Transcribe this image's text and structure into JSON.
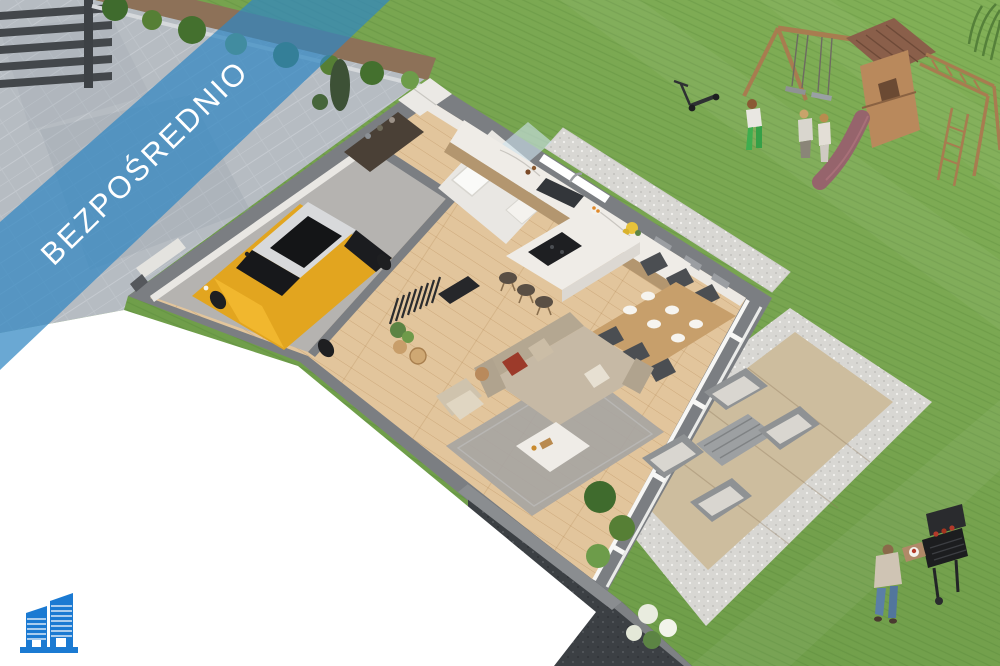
{
  "banner": {
    "label": "BEZPOŚREDNIO"
  },
  "logo": {
    "icon": "buildings-icon"
  },
  "palette": {
    "banner_blue": "#3187c2",
    "logo_blue": "#1b7ad2",
    "text_white": "#ffffff",
    "lawn_green": "#74a14d",
    "lawn_green_light": "#82b157",
    "driveway_gray": "#b6bcc2",
    "wall_gray": "#7b7e82",
    "floor_wood": "#e2c59c",
    "garage_floor": "#b5b3b0",
    "marble_white": "#efece7",
    "cabinet_wood": "#b3966f",
    "dining_wood": "#c79f6b",
    "sofa_beige": "#c6b9a5",
    "rug_gray": "#a6a4a2",
    "chair_dark": "#4b4e52",
    "car_yellow": "#e2a51f",
    "gravel_light": "#d8d7d3",
    "patio_beige": "#cdbd9e",
    "foundation_dark": "#3c4044",
    "playground_wood": "#b9895c",
    "slide_mauve": "#96646c",
    "hedge_mulch": "#8d7158",
    "bush_green": "#4e7a34",
    "fence_dark": "#43474b"
  },
  "scene": {
    "elements": [
      "driveway",
      "fence",
      "hedge",
      "lawn",
      "garage",
      "yellow-car",
      "hallway",
      "bathroom",
      "wardrobe",
      "kitchen",
      "kitchen-island",
      "dining-set",
      "living-room-sofa",
      "rug",
      "coffee-table",
      "window-wall",
      "patio-lounge",
      "gravel-path",
      "foundation-cut",
      "playground",
      "swing-set",
      "slide",
      "children",
      "kick-scooter",
      "barbecue-grill",
      "grill-man",
      "garden-bushes"
    ]
  }
}
